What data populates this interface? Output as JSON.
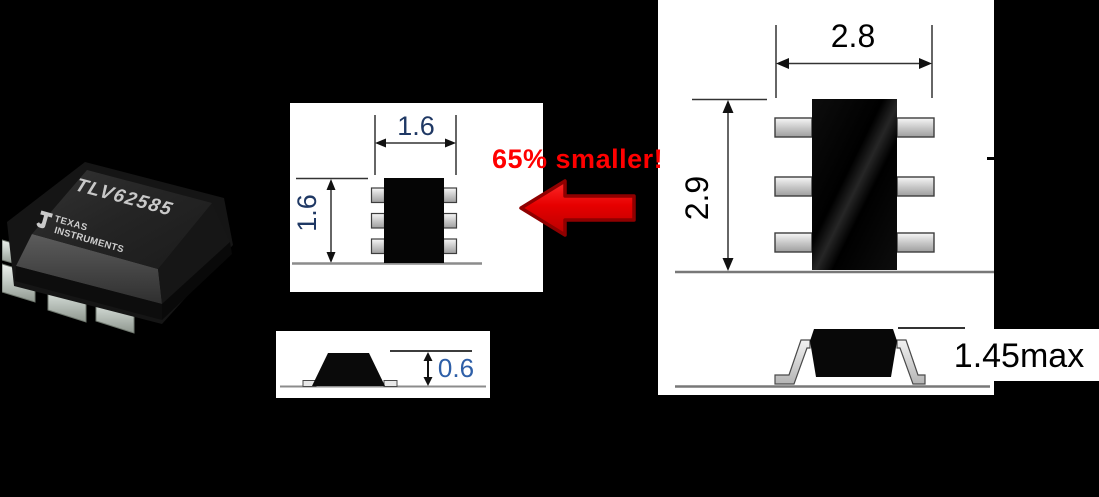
{
  "slide": {
    "background_color": "#000000",
    "chip_photo": {
      "part_number": "TLV62585",
      "brand_line1": "TEXAS",
      "brand_line2": "INSTRUMENTS"
    },
    "callout": {
      "label": "65% smaller!",
      "text_color": "#FF0000",
      "arrow_icon": "arrow-left-icon",
      "arrow_fill": "#E00000",
      "arrow_outline": "#8F0000"
    },
    "small_package": {
      "top_view": {
        "width_label": "1.6",
        "height_label": "1.6",
        "label_color": "#1F3864"
      },
      "side_view": {
        "height_label": "0.6",
        "label_color": "#2E5FA8"
      }
    },
    "large_package": {
      "top_view": {
        "width_label": "2.8",
        "height_label": "2.9",
        "label_color": "#000000"
      },
      "side_view": {
        "height_label": "1.45max",
        "label_color": "#000000"
      }
    }
  }
}
